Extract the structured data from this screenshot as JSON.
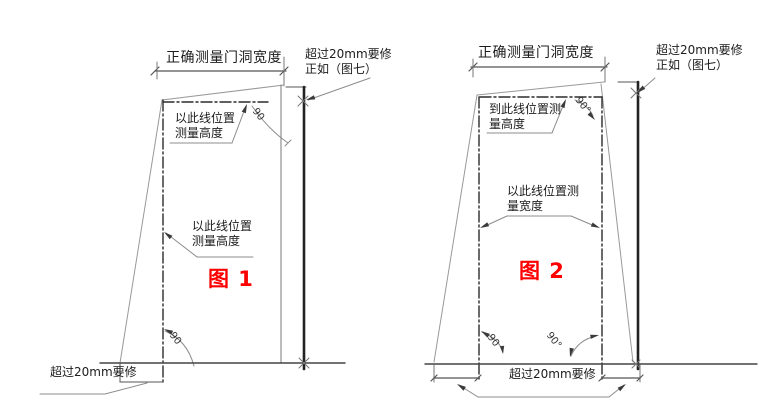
{
  "figure1": {
    "width_dimension_label": "正确测量门洞宽度",
    "overflow_note": {
      "line1": "超过20mm要修",
      "line2": "正如（图七）"
    },
    "height_note_top": {
      "line1": "以此线位置",
      "line2": "测量高度"
    },
    "height_note_middle": {
      "line1": "以此线位置",
      "line2": "测量高度"
    },
    "angle_top": "90",
    "angle_bottom": "90",
    "sill_note": "超过20mm要修",
    "caption": "图 1"
  },
  "figure2": {
    "width_dimension_label": "正确测量门洞宽度",
    "overflow_note": {
      "line1": "超过20mm要修",
      "line2": "正如（图七）"
    },
    "height_note": {
      "line1": "到此线位置测",
      "line2": "量高度"
    },
    "width_note": {
      "line1": "以此线位置测",
      "line2": "量宽度"
    },
    "angle_top": "90°",
    "angle_bottom_left": "90",
    "angle_bottom_right": "90°",
    "sill_note": "超过20mm要修",
    "caption": "图 2"
  },
  "colors": {
    "caption_red": "#ff0000",
    "line_ink": "#222222",
    "construction_gray": "#999999",
    "background": "#ffffff"
  }
}
